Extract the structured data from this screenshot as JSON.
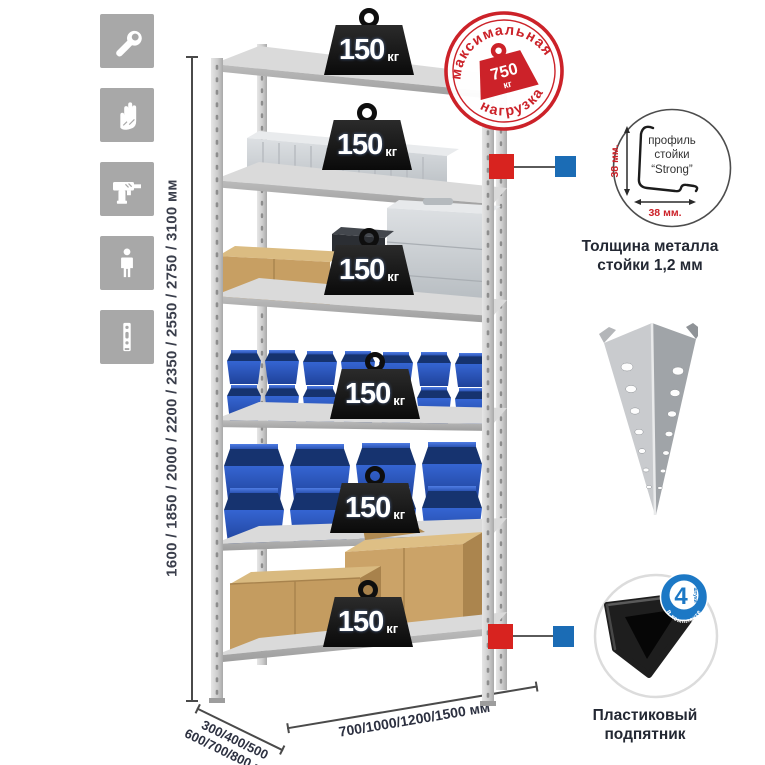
{
  "sidebar": {
    "tiles": [
      {
        "icon": "wrench"
      },
      {
        "icon": "gloves"
      },
      {
        "icon": "drill"
      },
      {
        "icon": "person"
      },
      {
        "icon": "rack-post"
      }
    ]
  },
  "dimensions": {
    "height_label": "1600 / 1850 / 2000 / 2200 / 2350 / 2550 / 2750 / 3100 мм",
    "depth_label_line1": "300/400/500",
    "depth_label_line2": "600/700/800 мм",
    "width_label": "700/1000/1200/1500 мм"
  },
  "shelf_load": {
    "value": "150",
    "unit": "кг"
  },
  "max_load_stamp": {
    "arc_top": "максимальная",
    "arc_bottom": "нагрузка",
    "value": "750",
    "unit": "кг"
  },
  "profile_detail": {
    "label_line1": "профиль",
    "label_line2": "стойки",
    "label_line3": "“Strong”",
    "dim_vertical": "38 мм.",
    "dim_horizontal": "38 мм.",
    "caption": "Толщина металла стойки 1,2 мм"
  },
  "foot_detail": {
    "badge_number": "4",
    "badge_word": "штуки",
    "badge_arc": "в комплекте",
    "caption": "Пластиковый подпятник"
  },
  "colors": {
    "stamp_red": "#cc2229",
    "callout_red": "#d8231f",
    "callout_blue": "#1b6cb5",
    "badge_blue": "#1c78c5",
    "bin_blue": "#2c5cc5",
    "tile_gray": "#a8a8a8",
    "text_dark": "#232833"
  }
}
